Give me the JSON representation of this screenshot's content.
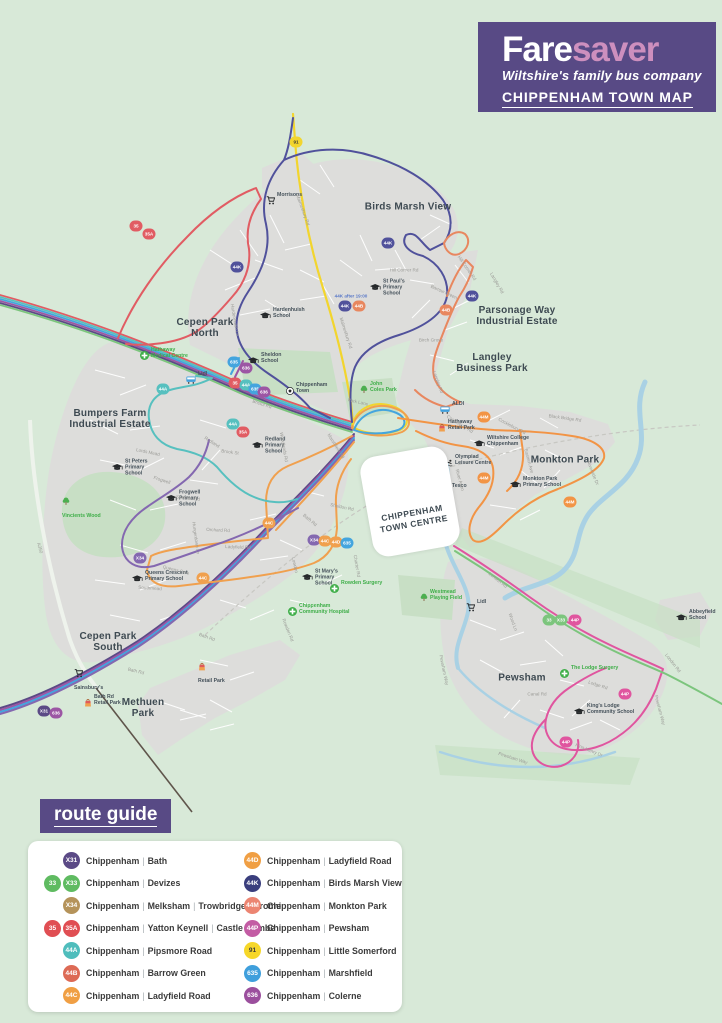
{
  "header": {
    "brand_bold": "Fare",
    "brand_light": "saver",
    "tagline": "Wiltshire's family bus company",
    "map_title": "CHIPPENHAM TOWN MAP"
  },
  "town_centre": {
    "label": "CHIPPENHAM\nTOWN CENTRE"
  },
  "route_guide": {
    "title": "route guide",
    "columns": [
      [
        {
          "badges": [
            {
              "label": "X31",
              "bg": "#5b4a86"
            }
          ],
          "parts": [
            "Chippenham",
            "Bath"
          ]
        },
        {
          "badges": [
            {
              "label": "33",
              "bg": "#5fbb61"
            },
            {
              "label": "X33",
              "bg": "#5fbb61"
            }
          ],
          "parts": [
            "Chippenham",
            "Devizes"
          ]
        },
        {
          "badges": [
            {
              "label": "X34",
              "bg": "#b5935a"
            }
          ],
          "parts": [
            "Chippenham",
            "Melksham",
            "Trowbridge",
            "Frome"
          ]
        },
        {
          "badges": [
            {
              "label": "35",
              "bg": "#e04e53"
            },
            {
              "label": "35A",
              "bg": "#e04e53"
            }
          ],
          "parts": [
            "Chippenham",
            "Yatton Keynell",
            "Castle Combe"
          ]
        },
        {
          "badges": [
            {
              "label": "44A",
              "bg": "#4fbdbc"
            }
          ],
          "parts": [
            "Chippenham",
            "Pipsmore Road"
          ]
        },
        {
          "badges": [
            {
              "label": "44B",
              "bg": "#dd6a55"
            }
          ],
          "parts": [
            "Chippenham",
            "Barrow Green"
          ]
        },
        {
          "badges": [
            {
              "label": "44C",
              "bg": "#f09f44"
            }
          ],
          "parts": [
            "Chippenham",
            "Ladyfield Road"
          ]
        }
      ],
      [
        {
          "badges": [
            {
              "label": "44D",
              "bg": "#f09f44"
            }
          ],
          "parts": [
            "Chippenham",
            "Ladyfield Road"
          ]
        },
        {
          "badges": [
            {
              "label": "44K",
              "bg": "#3a3e7d"
            }
          ],
          "parts": [
            "Chippenham",
            "Birds Marsh View"
          ]
        },
        {
          "badges": [
            {
              "label": "44M",
              "bg": "#ec8572"
            }
          ],
          "parts": [
            "Chippenham",
            "Monkton Park"
          ]
        },
        {
          "badges": [
            {
              "label": "44P",
              "bg": "#c35ca4"
            }
          ],
          "parts": [
            "Chippenham",
            "Pewsham"
          ]
        },
        {
          "badges": [
            {
              "label": "91",
              "bg": "#f6d729",
              "fg": "#3a3a3a"
            }
          ],
          "parts": [
            "Chippenham",
            "Little Somerford"
          ]
        },
        {
          "badges": [
            {
              "label": "635",
              "bg": "#3f9fdc"
            }
          ],
          "parts": [
            "Chippenham",
            "Marshfield"
          ]
        },
        {
          "badges": [
            {
              "label": "636",
              "bg": "#9b4f9d"
            }
          ],
          "parts": [
            "Chippenham",
            "Colerne"
          ]
        }
      ]
    ]
  },
  "map": {
    "route_colors": {
      "c35": "#e15c63",
      "c44a": "#57c0bf",
      "c635": "#44a5de",
      "c636": "#9c56a4",
      "cx31": "#5b4a86",
      "c33": "#7cc57d",
      "c91": "#f2d52e",
      "c44k": "#50519b",
      "c44b": "#e8875f",
      "c44m": "#f29445",
      "c44cd": "#f0a04e",
      "c44p": "#e0559f",
      "cx34": "#8468b0"
    },
    "areas": [
      {
        "name": "Birds Marsh View",
        "x": 408,
        "y": 207
      },
      {
        "name": "Cepen Park\nNorth",
        "x": 205,
        "y": 328
      },
      {
        "name": "Parsonage Way\nIndustrial Estate",
        "x": 517,
        "y": 316
      },
      {
        "name": "Langley\nBusiness Park",
        "x": 492,
        "y": 363
      },
      {
        "name": "Bumpers Farm\nIndustrial Estate",
        "x": 110,
        "y": 419
      },
      {
        "name": "Monkton Park",
        "x": 565,
        "y": 460
      },
      {
        "name": "Cepen Park\nSouth",
        "x": 108,
        "y": 642
      },
      {
        "name": "Methuen\nPark",
        "x": 143,
        "y": 708
      },
      {
        "name": "Pewsham",
        "x": 522,
        "y": 678
      }
    ],
    "pois": [
      {
        "name": "Morrisons",
        "icon": "cart",
        "x": 266,
        "y": 201
      },
      {
        "name": "Hardenhuish\nSchool",
        "icon": "school",
        "x": 260,
        "y": 316
      },
      {
        "name": "St Paul's\nPrimary\nSchool",
        "icon": "school",
        "x": 370,
        "y": 288
      },
      {
        "name": "Sheldon\nSchool",
        "icon": "school",
        "x": 248,
        "y": 361
      },
      {
        "name": "Hathaway\nMedical Centre",
        "icon": "medical",
        "x": 140,
        "y": 356,
        "green": true
      },
      {
        "name": "Lidl",
        "icon": "bus",
        "x": 186,
        "y": 380
      },
      {
        "name": "Chippenham\nTown",
        "icon": "football",
        "x": 286,
        "y": 391
      },
      {
        "name": "Redland\nPrimary\nSchool",
        "icon": "school",
        "x": 252,
        "y": 446
      },
      {
        "name": "St Peters\nPrimary\nSchool",
        "icon": "school",
        "x": 112,
        "y": 468
      },
      {
        "name": "Frogwell\nPrimary\nSchool",
        "icon": "school",
        "x": 166,
        "y": 499
      },
      {
        "name": "Vincients Wood",
        "icon": "tree",
        "x": 62,
        "y": 506,
        "green": true,
        "stack": true
      },
      {
        "name": "Queens Crescent\nPrimary School",
        "icon": "school",
        "x": 132,
        "y": 579
      },
      {
        "name": "St Mary's\nPrimary\nSchool",
        "icon": "school",
        "x": 302,
        "y": 578
      },
      {
        "name": "Rowden Surgery",
        "icon": "medical",
        "x": 330,
        "y": 589,
        "green": true
      },
      {
        "name": "Chippenham\nCommunity Hospital",
        "icon": "medical",
        "x": 288,
        "y": 612,
        "green": true
      },
      {
        "name": "Westmead\nPlaying Field",
        "icon": "tree",
        "x": 420,
        "y": 598,
        "green": true
      },
      {
        "name": "John\nColes Park",
        "icon": "tree",
        "x": 360,
        "y": 390,
        "green": true
      },
      {
        "name": "ALDI",
        "icon": "bus",
        "x": 440,
        "y": 410
      },
      {
        "name": "Hathaway\nRetail Park",
        "icon": "bag",
        "x": 438,
        "y": 428
      },
      {
        "name": "Wiltshire College\nChippenham",
        "icon": "school",
        "x": 474,
        "y": 444
      },
      {
        "name": "Olympiad\nLeisure Centre",
        "icon": "swim",
        "x": 444,
        "y": 463
      },
      {
        "name": "Tesco",
        "icon": "bus",
        "x": 440,
        "y": 492
      },
      {
        "name": "Monkton Park\nPrimary School",
        "icon": "school",
        "x": 510,
        "y": 485
      },
      {
        "name": "Lidl",
        "icon": "cart",
        "x": 466,
        "y": 608
      },
      {
        "name": "The Lodge Surgery",
        "icon": "medical",
        "x": 560,
        "y": 674,
        "green": true
      },
      {
        "name": "King's Lodge\nCommunity School",
        "icon": "school",
        "x": 574,
        "y": 712
      },
      {
        "name": "Abbeyfield\nSchool",
        "icon": "school",
        "x": 676,
        "y": 618
      },
      {
        "name": "Sainsbury's",
        "icon": "cart",
        "x": 74,
        "y": 678,
        "stack": true
      },
      {
        "name": "Bath Rd\nRetail Park",
        "icon": "bag",
        "x": 84,
        "y": 703
      },
      {
        "name": "Retail Park",
        "icon": "bag",
        "x": 198,
        "y": 671,
        "stack": true
      }
    ],
    "roads": [
      {
        "name": "Malmesbury Rd",
        "x": 303,
        "y": 210,
        "angle": 70
      },
      {
        "name": "Malmesbury Rd",
        "x": 346,
        "y": 333,
        "angle": 72
      },
      {
        "name": "Hill Corner Rd",
        "x": 404,
        "y": 270,
        "angle": 0
      },
      {
        "name": "Hill Corner Rd",
        "x": 467,
        "y": 268,
        "angle": 55
      },
      {
        "name": "Hardenhuish Ln",
        "x": 235,
        "y": 320,
        "angle": 80
      },
      {
        "name": "Bristol Rd",
        "x": 262,
        "y": 404,
        "angle": 18
      },
      {
        "name": "Sheldon Rd",
        "x": 188,
        "y": 498,
        "angle": 6
      },
      {
        "name": "Sheldon Rd",
        "x": 342,
        "y": 507,
        "angle": 12
      },
      {
        "name": "Orchard Rd",
        "x": 218,
        "y": 530,
        "angle": 3
      },
      {
        "name": "Ladyfield Rd",
        "x": 238,
        "y": 547,
        "angle": 2
      },
      {
        "name": "Hungerdown Ln",
        "x": 196,
        "y": 538,
        "angle": 82
      },
      {
        "name": "Lords Mead",
        "x": 148,
        "y": 452,
        "angle": 12
      },
      {
        "name": "Frogwell",
        "x": 162,
        "y": 480,
        "angle": 18
      },
      {
        "name": "Queens Cres",
        "x": 176,
        "y": 570,
        "angle": 14
      },
      {
        "name": "A350",
        "x": 40,
        "y": 548,
        "angle": 75
      },
      {
        "name": "Bath Rd",
        "x": 310,
        "y": 520,
        "angle": 40
      },
      {
        "name": "Bath Rd",
        "x": 136,
        "y": 671,
        "angle": 14
      },
      {
        "name": "Bath Rd",
        "x": 207,
        "y": 637,
        "angle": 20
      },
      {
        "name": "Lowden",
        "x": 295,
        "y": 565,
        "angle": 78
      },
      {
        "name": "Charter Rd",
        "x": 357,
        "y": 566,
        "angle": 80
      },
      {
        "name": "Rowden Rd",
        "x": 288,
        "y": 630,
        "angle": 68
      },
      {
        "name": "Park Lane",
        "x": 358,
        "y": 402,
        "angle": 12
      },
      {
        "name": "Marshfield Rd",
        "x": 336,
        "y": 446,
        "angle": 58
      },
      {
        "name": "Cocklebury Rd",
        "x": 460,
        "y": 424,
        "angle": 32
      },
      {
        "name": "Cocklebury Rd",
        "x": 512,
        "y": 426,
        "angle": 28
      },
      {
        "name": "Black Bridge Rd",
        "x": 565,
        "y": 418,
        "angle": 8
      },
      {
        "name": "Eastern Ave",
        "x": 529,
        "y": 461,
        "angle": 75
      },
      {
        "name": "Riverside Dr",
        "x": 593,
        "y": 473,
        "angle": 68
      },
      {
        "name": "River Avon",
        "x": 460,
        "y": 480,
        "angle": 75
      },
      {
        "name": "London Rd",
        "x": 498,
        "y": 580,
        "angle": 38
      },
      {
        "name": "London Rd",
        "x": 673,
        "y": 663,
        "angle": 52
      },
      {
        "name": "Wood Ln",
        "x": 513,
        "y": 622,
        "angle": 70
      },
      {
        "name": "Pewsham Way",
        "x": 444,
        "y": 670,
        "angle": 78
      },
      {
        "name": "Pewsham Way",
        "x": 513,
        "y": 758,
        "angle": 18
      },
      {
        "name": "Pewsham Way",
        "x": 660,
        "y": 710,
        "angle": 75
      },
      {
        "name": "Lodge Rd",
        "x": 598,
        "y": 685,
        "angle": 18
      },
      {
        "name": "Canal Rd",
        "x": 537,
        "y": 694,
        "angle": 0
      },
      {
        "name": "King Henry Dr",
        "x": 589,
        "y": 750,
        "angle": 22
      },
      {
        "name": "Langley Rd",
        "x": 497,
        "y": 283,
        "angle": 60
      },
      {
        "name": "Langley Rd",
        "x": 438,
        "y": 382,
        "angle": 70
      },
      {
        "name": "Birch Grove",
        "x": 431,
        "y": 340,
        "angle": 0
      },
      {
        "name": "Barrow Green",
        "x": 444,
        "y": 292,
        "angle": 25
      },
      {
        "name": "Brook St",
        "x": 230,
        "y": 452,
        "angle": 8
      },
      {
        "name": "Redland",
        "x": 212,
        "y": 442,
        "angle": 32
      },
      {
        "name": "Woodlands Rd",
        "x": 284,
        "y": 447,
        "angle": 80
      },
      {
        "name": "Southmead",
        "x": 150,
        "y": 588,
        "angle": 4
      }
    ],
    "badges": [
      {
        "label": "35",
        "key": "c35",
        "x": 136,
        "y": 226
      },
      {
        "label": "35A",
        "key": "c35",
        "x": 149,
        "y": 234
      },
      {
        "label": "44K",
        "key": "c44k",
        "x": 237,
        "y": 267
      },
      {
        "label": "91",
        "key": "c91",
        "x": 296,
        "y": 142,
        "fg": "#3a3a3a"
      },
      {
        "label": "44K",
        "key": "c44k",
        "x": 388,
        "y": 243
      },
      {
        "label": "44K",
        "key": "c44k",
        "x": 345,
        "y": 306
      },
      {
        "label": "44B",
        "key": "c44b",
        "x": 359,
        "y": 306
      },
      {
        "label": "44B",
        "key": "c44b",
        "x": 446,
        "y": 310
      },
      {
        "label": "44K",
        "key": "c44k",
        "x": 472,
        "y": 296
      },
      {
        "label": "635",
        "key": "c635",
        "x": 234,
        "y": 362
      },
      {
        "label": "636",
        "key": "c636",
        "x": 246,
        "y": 368
      },
      {
        "label": "35",
        "key": "c35",
        "x": 235,
        "y": 383
      },
      {
        "label": "44A",
        "key": "c44a",
        "x": 246,
        "y": 385
      },
      {
        "label": "635",
        "key": "c635",
        "x": 255,
        "y": 389
      },
      {
        "label": "636",
        "key": "c636",
        "x": 264,
        "y": 392
      },
      {
        "label": "44A",
        "key": "c44a",
        "x": 163,
        "y": 389
      },
      {
        "label": "44A",
        "key": "c44a",
        "x": 233,
        "y": 424
      },
      {
        "label": "35A",
        "key": "c35",
        "x": 243,
        "y": 432
      },
      {
        "label": "X34",
        "key": "cx34",
        "x": 140,
        "y": 558
      },
      {
        "label": "44C",
        "key": "c44cd",
        "x": 269,
        "y": 523
      },
      {
        "label": "44C",
        "key": "c44cd",
        "x": 203,
        "y": 578
      },
      {
        "label": "X34",
        "key": "cx34",
        "x": 314,
        "y": 540
      },
      {
        "label": "44C",
        "key": "c44cd",
        "x": 325,
        "y": 541
      },
      {
        "label": "44D",
        "key": "c44cd",
        "x": 336,
        "y": 542
      },
      {
        "label": "635",
        "key": "c635",
        "x": 347,
        "y": 543
      },
      {
        "label": "X31",
        "key": "cx31",
        "x": 44,
        "y": 711
      },
      {
        "label": "636",
        "key": "c636",
        "x": 56,
        "y": 713
      },
      {
        "label": "33",
        "key": "c33",
        "x": 549,
        "y": 620
      },
      {
        "label": "X33",
        "key": "c33",
        "x": 561,
        "y": 620
      },
      {
        "label": "44P",
        "key": "c44p",
        "x": 575,
        "y": 620
      },
      {
        "label": "44P",
        "key": "c44p",
        "x": 625,
        "y": 694
      },
      {
        "label": "44P",
        "key": "c44p",
        "x": 566,
        "y": 742
      },
      {
        "label": "44M",
        "key": "c44m",
        "x": 484,
        "y": 417
      },
      {
        "label": "44M",
        "key": "c44m",
        "x": 484,
        "y": 478
      },
      {
        "label": "44M",
        "key": "c44m",
        "x": 570,
        "y": 502
      }
    ],
    "notes": [
      {
        "text": "44K after 19:00",
        "x": 351,
        "y": 296
      }
    ]
  }
}
